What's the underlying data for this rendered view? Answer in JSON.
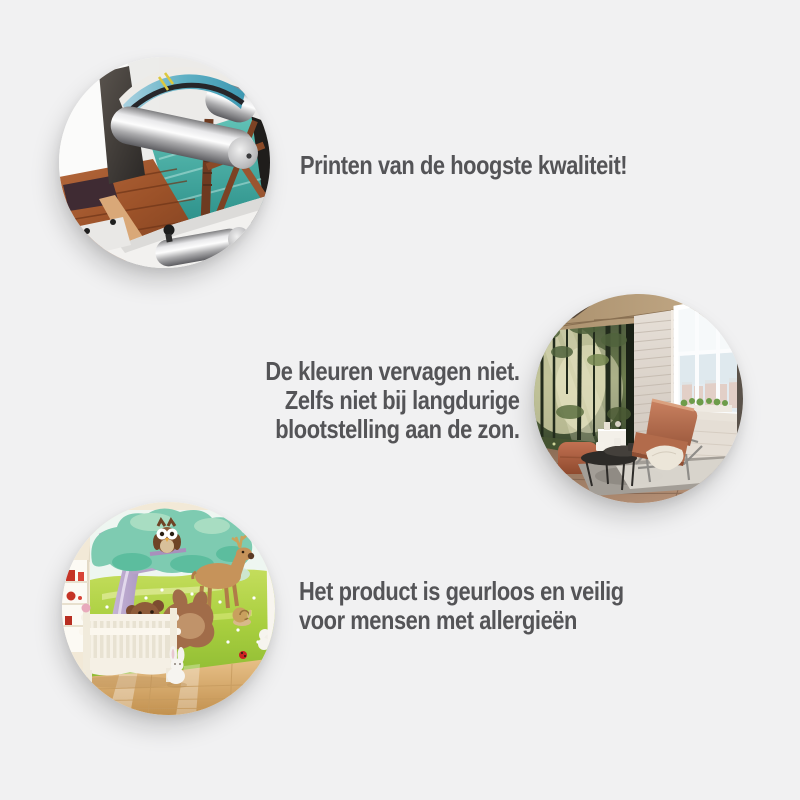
{
  "canvas": {
    "background_color": "#f1f1f2",
    "text_color": "#545457"
  },
  "features": [
    {
      "name": "print-quality",
      "photo": "printing-machine-photo",
      "alt": "Printer with silver roller printing a colourful mural of a wooden pier over turquoise water",
      "lines": [
        "Printen van de hoogste kwaliteit!"
      ]
    },
    {
      "name": "fade-resistance",
      "photo": "sunlit-interior-photo",
      "alt": "Living room with sunlit forest wall mural, white brick wall, large window and cognac leather armchair",
      "lines": [
        "De kleuren vervagen niet.",
        "Zelfs niet bij langdurige",
        "blootstelling aan de zon."
      ]
    },
    {
      "name": "allergy-friendly",
      "photo": "nursery-photo",
      "alt": "Nursery with white crib in front of a cartoon mural with tree, owl, deer and playing bears",
      "lines": [
        "Het product is geurloos en veilig",
        "voor mensen met allergieën"
      ]
    }
  ]
}
